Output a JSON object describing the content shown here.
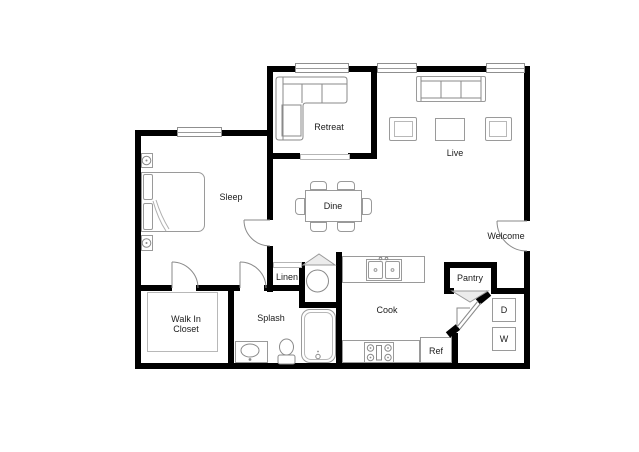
{
  "floorplan": {
    "rooms": {
      "sleep": "Sleep",
      "retreat": "Retreat",
      "live": "Live",
      "dine": "Dine",
      "welcome": "Welcome",
      "linen": "Linen",
      "splash": "Splash",
      "walk_in_closet_line1": "Walk In",
      "walk_in_closet_line2": "Closet",
      "cook": "Cook",
      "pantry": "Pantry"
    },
    "appliances": {
      "refrigerator": "Ref",
      "dryer": "D",
      "washer": "W"
    },
    "colors": {
      "wall": "#000000",
      "fixture_outline": "#999999",
      "background": "#ffffff"
    }
  }
}
